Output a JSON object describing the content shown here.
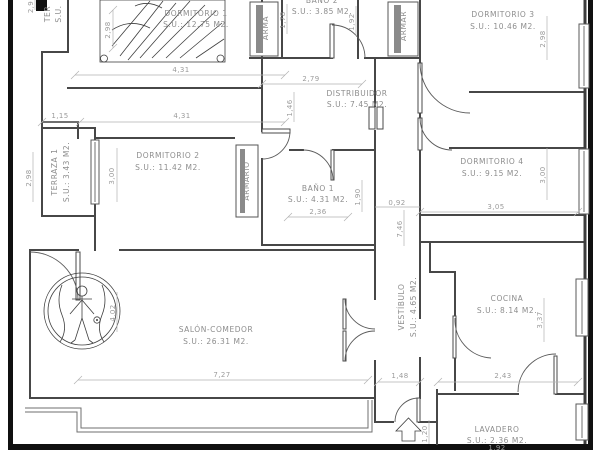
{
  "rooms": {
    "dormitorio1": {
      "name": "DORMITORIO 1",
      "area": "S.U.: 12.75 M2."
    },
    "banio2": {
      "name": "BAÑO 2",
      "area": "S.U.: 3.85 M2."
    },
    "dormitorio3": {
      "name": "DORMITORIO 3",
      "area": "S.U.: 10.46 M2."
    },
    "distribuidor": {
      "name": "DISTRIBUIDOR",
      "area": "S.U.: 7.45 M2."
    },
    "terraza1": {
      "name": "TERRAZA 1",
      "area": "S.U.: 3.43 M2."
    },
    "dormitorio2": {
      "name": "DORMITORIO 2",
      "area": "S.U.: 11.42 M2."
    },
    "banio1": {
      "name": "BAÑO 1",
      "area": "S.U.: 4.31 M2."
    },
    "dormitorio4": {
      "name": "DORMITORIO 4",
      "area": "S.U.: 9.15 M2."
    },
    "salon": {
      "name": "SALÓN-COMEDOR",
      "area": "S.U.: 26.31 M2."
    },
    "vestibulo": {
      "name": "VESTÍBULO",
      "area": "S.U.: 4.65 M2."
    },
    "cocina": {
      "name": "COCINA",
      "area": "S.U.: 8.14 M2."
    },
    "lavadero": {
      "name": "LAVADERO",
      "area": "S.U.: 2.36 M2."
    }
  },
  "closets": {
    "left_top": "ARMA",
    "right_top": "ARMAR",
    "dorm2": "ARMARIO"
  },
  "partial_labels": {
    "terraza_top_line1": "TER",
    "terraza_top_line2": "S.U."
  },
  "dims": {
    "dorm1_height": "2,98",
    "dorm1_width": "4,31",
    "banio2_left": "1,78",
    "banio2_right": "1,92",
    "dorm3_height": "2,98",
    "distrib_width": "2,79",
    "distrib_left": "1,46",
    "hall_left": "1,15",
    "hall_right": "4,31",
    "terraza_height": "2,98",
    "dorm2_height": "3,00",
    "banio1_width": "2,36",
    "banio1_height": "1,90",
    "corridor_width": "0,92",
    "corridor_length": "7,46",
    "dorm4_height": "3,00",
    "dorm4_width": "3,05",
    "salon_height": "4,02",
    "salon_width": "7,27",
    "cocina_height": "3,37",
    "entry_width": "1,48",
    "cocina_width": "2,43",
    "lavadero_height": "1,20",
    "lavadero_width": "1,92",
    "top_left_cut": "2,9"
  }
}
